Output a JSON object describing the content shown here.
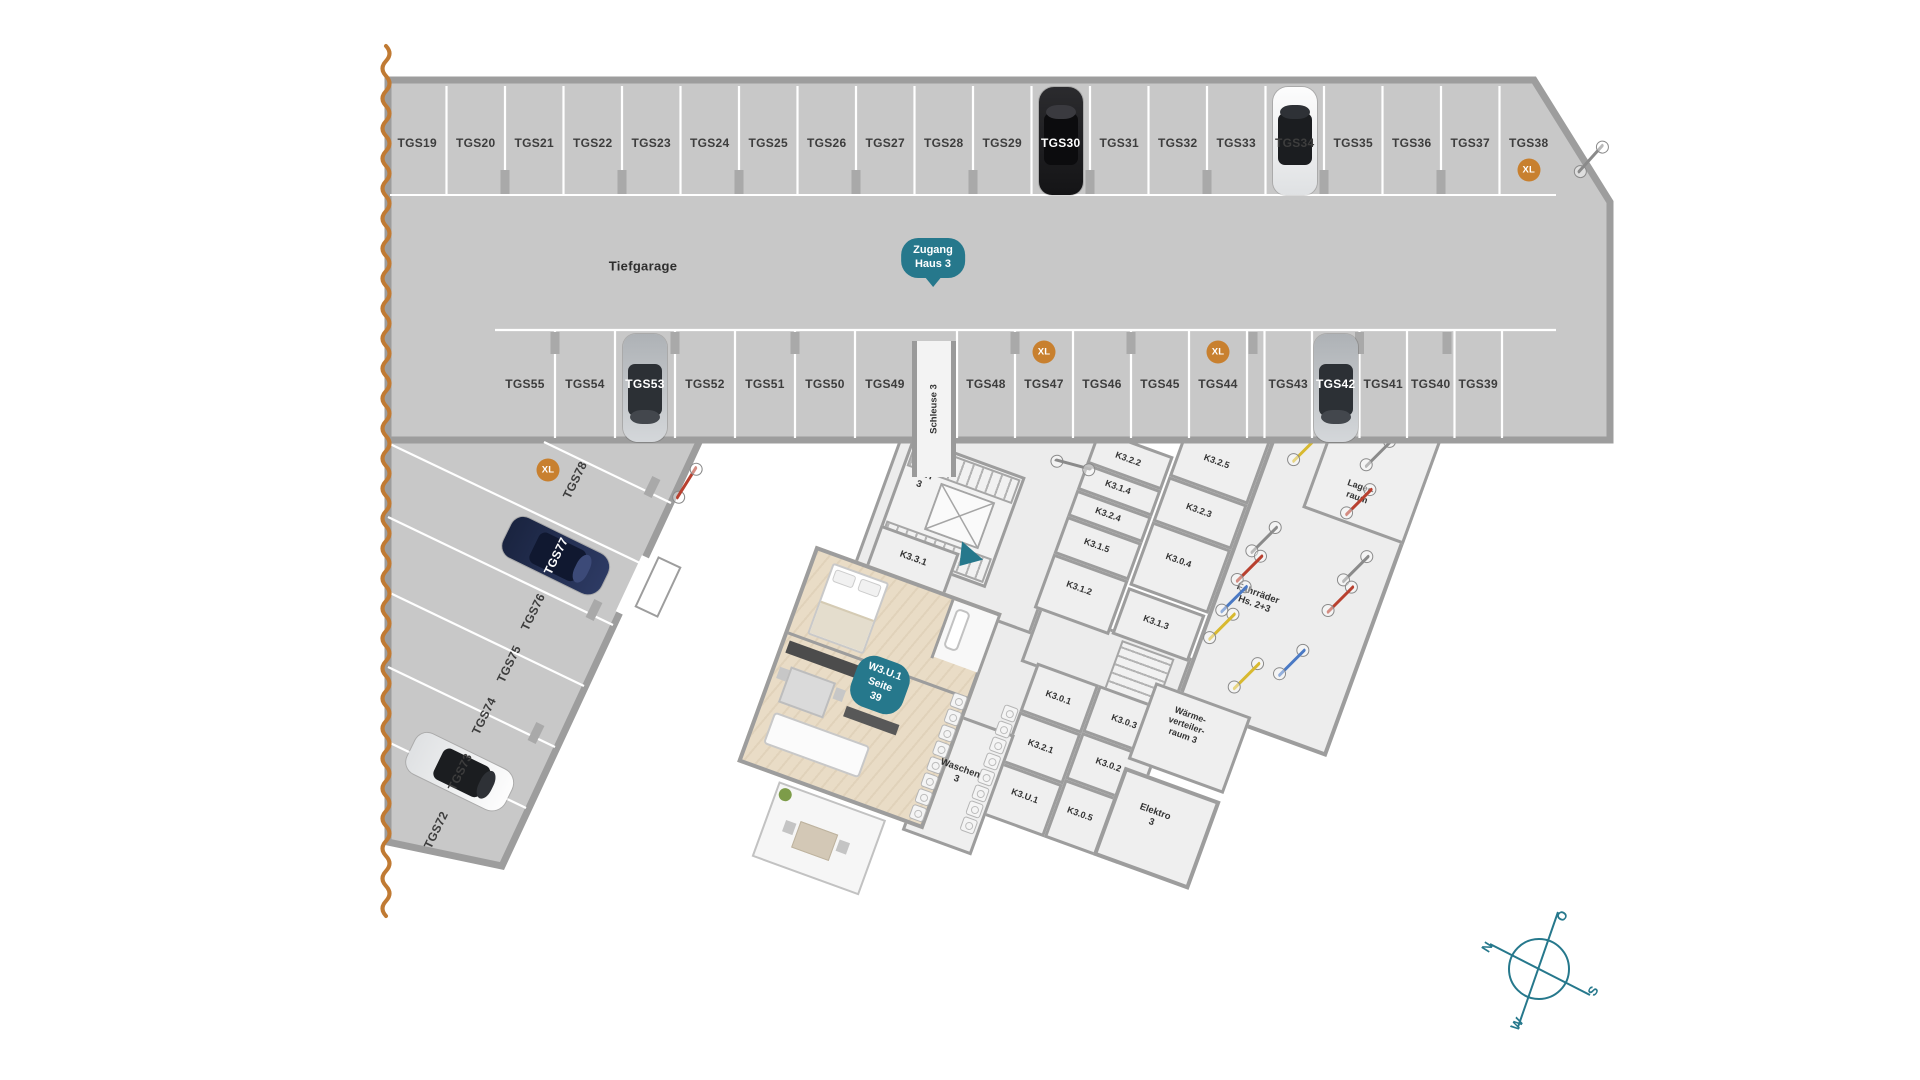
{
  "labels": {
    "tiefgarage": "Tiefgarage",
    "schleuse": "Schleuse 3",
    "xl": "XL"
  },
  "badges": {
    "zugang": {
      "line1": "Zugang",
      "line2": "Haus 3"
    },
    "unit": {
      "line1": "W3.U.1",
      "line2": "Seite 39"
    }
  },
  "compass": {
    "n": "N",
    "o": "O",
    "s": "S",
    "w": "W"
  },
  "parking": {
    "top_row": {
      "spots": [
        {
          "id": "TGS19"
        },
        {
          "id": "TGS20"
        },
        {
          "id": "TGS21"
        },
        {
          "id": "TGS22"
        },
        {
          "id": "TGS23"
        },
        {
          "id": "TGS24"
        },
        {
          "id": "TGS25"
        },
        {
          "id": "TGS26"
        },
        {
          "id": "TGS27"
        },
        {
          "id": "TGS28"
        },
        {
          "id": "TGS29"
        },
        {
          "id": "TGS30",
          "car": "black"
        },
        {
          "id": "TGS31"
        },
        {
          "id": "TGS32"
        },
        {
          "id": "TGS33"
        },
        {
          "id": "TGS34",
          "car": "white"
        },
        {
          "id": "TGS35"
        },
        {
          "id": "TGS36"
        },
        {
          "id": "TGS37"
        },
        {
          "id": "TGS38",
          "xl": true
        }
      ]
    },
    "mid_left": {
      "spots": [
        {
          "id": "TGS55"
        },
        {
          "id": "TGS54"
        },
        {
          "id": "TGS53",
          "car": "silver"
        },
        {
          "id": "TGS52"
        },
        {
          "id": "TGS51"
        },
        {
          "id": "TGS50"
        },
        {
          "id": "TGS49"
        }
      ]
    },
    "mid_center": {
      "spots": [
        {
          "id": "TGS48"
        },
        {
          "id": "TGS47",
          "xl": true
        },
        {
          "id": "TGS46"
        },
        {
          "id": "TGS45"
        },
        {
          "id": "TGS44",
          "xl": true
        }
      ]
    },
    "mid_right": {
      "spots": [
        {
          "id": "TGS43"
        },
        {
          "id": "TGS42",
          "car": "silver"
        },
        {
          "id": "TGS41"
        },
        {
          "id": "TGS40"
        },
        {
          "id": "TGS39"
        }
      ]
    },
    "left_column": {
      "spots": [
        {
          "id": "TGS78",
          "xl": true
        },
        {
          "id": "TGS77",
          "car": "navy"
        },
        {
          "id": "TGS76"
        },
        {
          "id": "TGS75"
        },
        {
          "id": "TGS74"
        },
        {
          "id": "TGS73",
          "car": "white"
        },
        {
          "id": "TGS72"
        }
      ]
    }
  },
  "building": {
    "rooms": [
      {
        "id": "trh3",
        "lines": [
          "TRH",
          "3"
        ],
        "x": 80,
        "y": 130,
        "fs": 9.5
      },
      {
        "id": "k331",
        "lines": [
          "K3.3.1"
        ],
        "x": 100,
        "y": 207,
        "fs": 9.5
      },
      {
        "id": "k322",
        "lines": [
          "K3.2.2"
        ],
        "x": 268,
        "y": 40,
        "fs": 9
      },
      {
        "id": "k314",
        "lines": [
          "K3.1.4"
        ],
        "x": 268,
        "y": 70,
        "fs": 9
      },
      {
        "id": "k324",
        "lines": [
          "K3.2.4"
        ],
        "x": 268,
        "y": 99,
        "fs": 9
      },
      {
        "id": "k315",
        "lines": [
          "K3.1.5"
        ],
        "x": 268,
        "y": 132,
        "fs": 9
      },
      {
        "id": "k312",
        "lines": [
          "K3.1.2"
        ],
        "x": 266,
        "y": 178,
        "fs": 9
      },
      {
        "id": "k313",
        "lines": [
          "K3.1.3"
        ],
        "x": 350,
        "y": 184,
        "fs": 9
      },
      {
        "id": "k325",
        "lines": [
          "K3.2.5"
        ],
        "x": 352,
        "y": 12,
        "fs": 9
      },
      {
        "id": "k323",
        "lines": [
          "K3.2.3"
        ],
        "x": 352,
        "y": 64,
        "fs": 9
      },
      {
        "id": "k304",
        "lines": [
          "K3.0.4"
        ],
        "x": 350,
        "y": 118,
        "fs": 9
      },
      {
        "id": "lagerraum",
        "lines": [
          "Lager-",
          "raum"
        ],
        "x": 496,
        "y": -8,
        "fs": 9
      },
      {
        "id": "fahrraeder",
        "lines": [
          "Fahrräder",
          "Hs. 2+3"
        ],
        "x": 436,
        "y": 128,
        "fs": 9.5
      },
      {
        "id": "waerme",
        "lines": [
          "Wärme-",
          "verteiler-",
          "raum 3"
        ],
        "x": 414,
        "y": 270,
        "fs": 9
      },
      {
        "id": "waschen",
        "lines": [
          "Waschen",
          "3"
        ],
        "x": 216,
        "y": 394,
        "fs": 9.5
      },
      {
        "id": "k301",
        "lines": [
          "K3.0.1"
        ],
        "x": 284,
        "y": 288,
        "fs": 9
      },
      {
        "id": "k303",
        "lines": [
          "K3.0.3"
        ],
        "x": 354,
        "y": 288,
        "fs": 9
      },
      {
        "id": "k321",
        "lines": [
          "K3.2.1"
        ],
        "x": 284,
        "y": 340,
        "fs": 9
      },
      {
        "id": "k302",
        "lines": [
          "K3.0.2"
        ],
        "x": 354,
        "y": 334,
        "fs": 9
      },
      {
        "id": "k3u1",
        "lines": [
          "K3.U.1"
        ],
        "x": 286,
        "y": 392,
        "fs": 9
      },
      {
        "id": "k305",
        "lines": [
          "K3.0.5"
        ],
        "x": 344,
        "y": 390,
        "fs": 9
      },
      {
        "id": "elektro",
        "lines": [
          "Elektro",
          "3"
        ],
        "x": 414,
        "y": 368,
        "fs": 9.5
      }
    ]
  }
}
